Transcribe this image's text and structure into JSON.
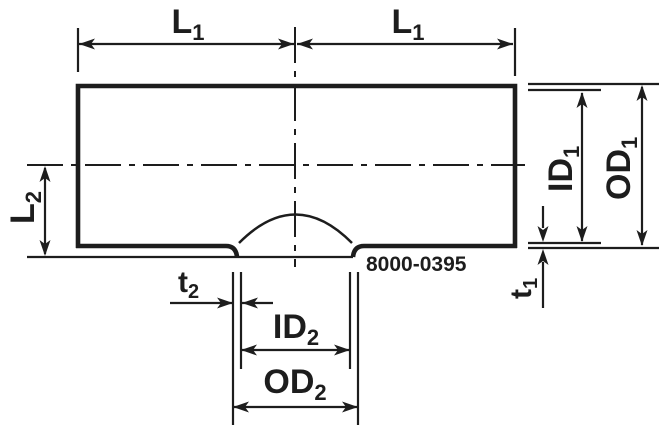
{
  "figure_number": "8000-0395",
  "dimensions": {
    "l1_left": {
      "main": "L",
      "sub": "1"
    },
    "l1_right": {
      "main": "L",
      "sub": "1"
    },
    "l2": {
      "main": "L",
      "sub": "2"
    },
    "id1": {
      "main": "ID",
      "sub": "1"
    },
    "od1": {
      "main": "OD",
      "sub": "1"
    },
    "t1": {
      "main": "t",
      "sub": "1"
    },
    "t2": {
      "main": "t",
      "sub": "2"
    },
    "id2": {
      "main": "ID",
      "sub": "2"
    },
    "od2": {
      "main": "OD",
      "sub": "2"
    }
  },
  "colors": {
    "line": "#1d1d1d",
    "background": "#ffffff"
  }
}
